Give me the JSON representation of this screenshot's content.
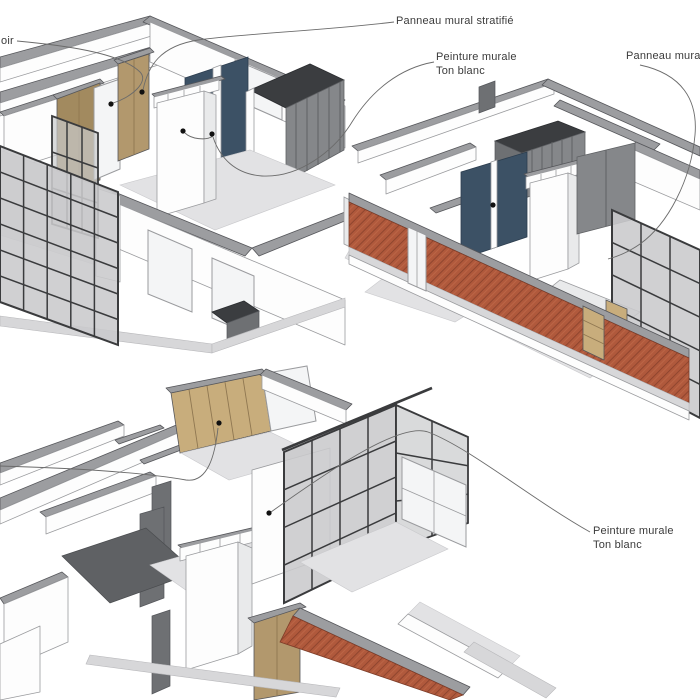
{
  "document": {
    "kind": "interior-axonometric-annotation-drawing",
    "language": "fr",
    "views": [
      {
        "id": "view-top-left",
        "materials": [
          "panneau mural stratifié (bois)",
          "peinture murale ton blanc",
          "panneau bleu",
          "paroi à lattes grises",
          "verrière à cadre noir"
        ]
      },
      {
        "id": "view-top-right",
        "materials": [
          "mur de briques",
          "panneau bleu",
          "verrière à cadre noir",
          "panneau bois"
        ]
      },
      {
        "id": "view-bottom",
        "materials": [
          "panneau mural stratifié (bois)",
          "peinture murale ton blanc",
          "verrière à cadre noir",
          "mur de briques"
        ]
      }
    ]
  },
  "annotations": {
    "partial_left": {
      "text": "oir"
    },
    "laminate_panel_top": {
      "text": "Panneau mural stratifié"
    },
    "wall_paint_top": {
      "line1": "Peinture murale",
      "line2": "Ton blanc"
    },
    "laminate_panel_right": {
      "text": "Panneau mural str"
    },
    "wall_paint_bottom": {
      "line1": "Peinture murale",
      "line2": "Ton blanc"
    }
  },
  "colors": {
    "background": "#ffffff",
    "label-text": "#3b3b3b",
    "leader": "#6b6b6b",
    "edge": "#55565a",
    "edge-soft": "#9a9b9e",
    "cap": "#9c9da0",
    "wall-white": "#fdfdfd",
    "wall-shade": "#e9eaeb",
    "floor": "#e2e2e4",
    "floor-dark": "#d7d7d9",
    "wood": "#c8ad7c",
    "wood-mid": "#b2986d",
    "wood-dark": "#a28a5f",
    "wood-seam": "#8f7751",
    "blue": "#3c5165",
    "panel-gray": "#85878a",
    "panel-darktop": "#3b3d40",
    "dark-floor": "#5f6164",
    "dark-panel": "#6e7073",
    "brick": "#b0593c",
    "brick-line": "#8a422c",
    "frame-black": "#3a3b3d",
    "glass": "#c9cacc"
  }
}
